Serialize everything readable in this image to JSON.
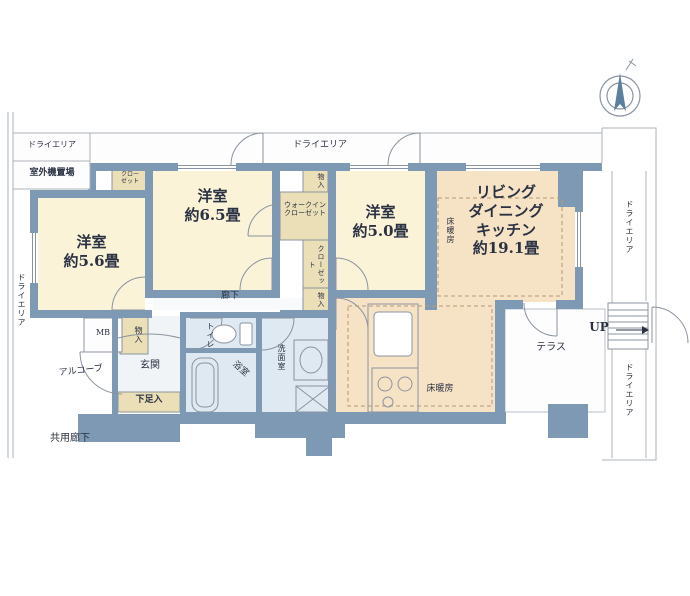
{
  "colors": {
    "wall": "#7e99b4",
    "room_cream": "#fbf3d8",
    "ldk_peach": "#f6e3c6",
    "closet_tan": "#eadfb6",
    "water_blue": "#dfe9f1",
    "line_gray": "#8a94a0",
    "text": "#2a3142"
  },
  "rooms": {
    "bedroom_56": {
      "name": "洋室",
      "size": "約5.6畳"
    },
    "bedroom_65": {
      "name": "洋室",
      "size": "約6.5畳"
    },
    "bedroom_50": {
      "name": "洋室",
      "size": "約5.0畳"
    },
    "ldk": {
      "line1": "リビング",
      "line2": "ダイニング",
      "line3": "キッチン",
      "size": "約19.1畳"
    }
  },
  "storage": {
    "wic_line1": "ウォークイン",
    "wic_line2": "クローゼット",
    "closet_small_line1": "クロー",
    "closet_small_line2": "ゼット",
    "closet_mid": "クローゼット",
    "storage_top": "物入",
    "storage_mid": "物入",
    "storage_entry": "物入",
    "shoe_box": "下足入"
  },
  "wet_areas": {
    "toilet": "トイレ",
    "washroom": "洗面室",
    "bathroom": "浴室"
  },
  "spaces": {
    "corridor": "廊下",
    "entrance": "玄関",
    "alcove": "アルコーブ",
    "common_corridor": "共用廊下",
    "terrace": "テラス",
    "meter_box": "MB"
  },
  "outdoor": {
    "dry_area_top_left": "ドライエリア",
    "outdoor_unit_space": "室外機置場",
    "dry_area_top": "ドライエリア",
    "dry_area_left": "ドライエリア",
    "dry_area_right_upper": "ドライエリア",
    "dry_area_right_lower": "ドライエリア"
  },
  "features": {
    "floor_heating_ldk": "床暖房",
    "floor_heating_kitchen": "床暖房",
    "stairs_up": "UP"
  }
}
